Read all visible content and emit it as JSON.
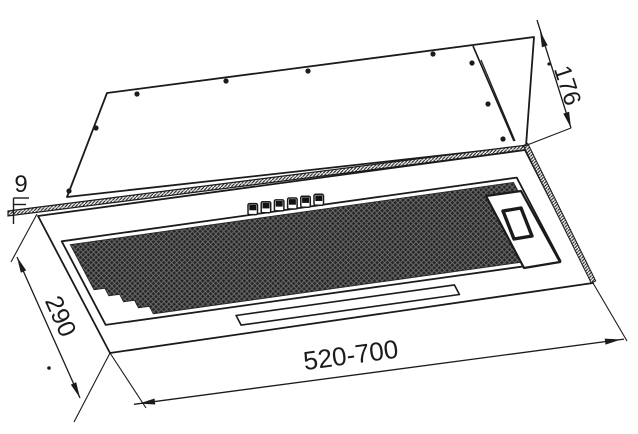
{
  "drawing": {
    "dimension_labels": {
      "top_depth": "176",
      "flange_thickness": "9",
      "body_depth": "290",
      "width_range": "520-700"
    },
    "features": {
      "mounting_holes": 9,
      "control_buttons": 6
    },
    "line_color": "#1b1b1b",
    "background": "#ffffff"
  }
}
